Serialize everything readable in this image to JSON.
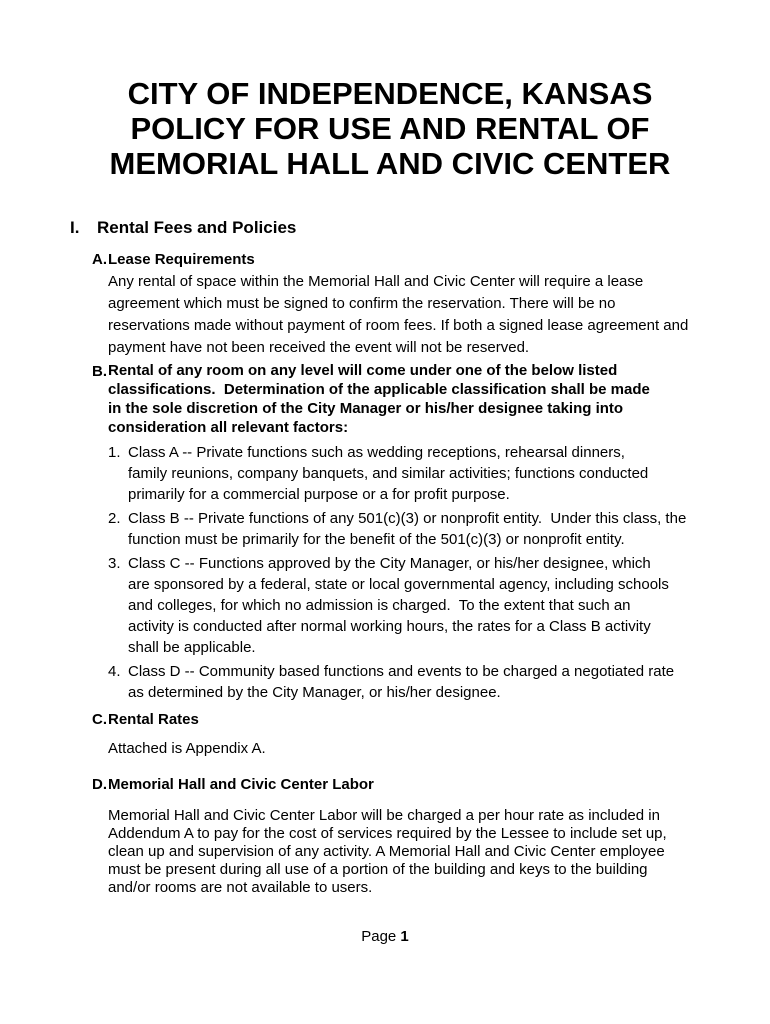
{
  "document": {
    "title_line1": "CITY OF INDEPENDENCE, KANSAS",
    "title_line2": "POLICY FOR USE AND RENTAL OF",
    "title_line3": "MEMORIAL HALL AND CIVIC CENTER",
    "section": {
      "number": "I.",
      "heading": "Rental Fees and Policies"
    },
    "items": {
      "a": {
        "label": "A.",
        "heading": "Lease Requirements",
        "body": "Any rental of space within the Memorial Hall and Civic Center will require a lease\nagreement which must be signed to confirm the reservation. There will be no\nreservations made without payment of room fees. If both a signed lease agreement and\npayment have not been received the event will not be reserved."
      },
      "b": {
        "label": "B.",
        "heading": "Rental of any room on any level will come under one of the below listed\nclassifications.  Determination of the applicable classification shall be made\nin the sole discretion of the City Manager or his/her designee taking into\nconsideration all relevant factors:",
        "list": [
          {
            "number": "1.",
            "text": "Class A -- Private functions such as wedding receptions, rehearsal dinners,\nfamily reunions, company banquets, and similar activities; functions conducted\nprimarily for a commercial purpose or a for profit purpose."
          },
          {
            "number": "2.",
            "text": "Class B -- Private functions of any 501(c)(3) or nonprofit entity.  Under this class, the\nfunction must be primarily for the benefit of the 501(c)(3) or nonprofit entity."
          },
          {
            "number": "3.",
            "text": "Class C -- Functions approved by the City Manager, or his/her designee, which\nare sponsored by a federal, state or local governmental agency, including schools\nand colleges, for which no admission is charged.  To the extent that such an\nactivity is conducted after normal working hours, the rates for a Class B activity\nshall be applicable."
          },
          {
            "number": "4.",
            "text": "Class D -- Community based functions and events to be charged a negotiated rate\nas determined by the City Manager, or his/her designee."
          }
        ]
      },
      "c": {
        "label": "C.",
        "heading": "Rental Rates",
        "body": "Attached is Appendix A."
      },
      "d": {
        "label": "D.",
        "heading": "Memorial Hall and Civic Center Labor",
        "body": "Memorial Hall and Civic Center Labor will be charged a per hour rate as included in\nAddendum A to pay for the cost of services required by the Lessee to include set up,\nclean up and supervision of any activity. A Memorial Hall and Civic Center employee\nmust be present during all use of a portion of the building and keys to the building\nand/or rooms are not available to users."
      }
    },
    "footer": {
      "page_label": "Page ",
      "page_number": "1"
    }
  }
}
